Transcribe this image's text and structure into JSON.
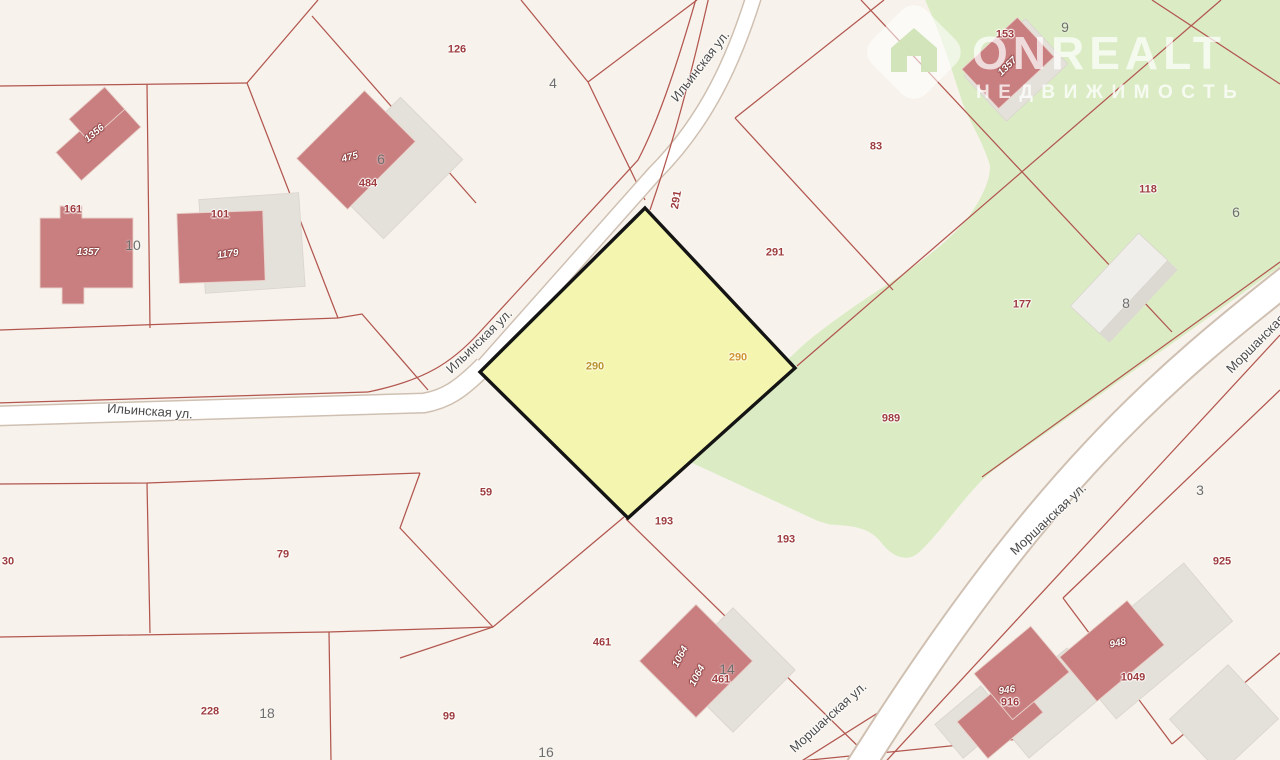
{
  "watermark": {
    "brand": "ONREALT",
    "subtitle": "НЕДВИЖИМОСТЬ"
  },
  "map": {
    "colors": {
      "background": "#f7f3ec",
      "green_zone": "#dbecc5",
      "parcel_line": "#b2564f",
      "street_fill": "#ffffff",
      "street_casing": "#cfc0b2",
      "highlight_fill": "#f4f6b0",
      "highlight_inner": "#eef28c",
      "highlight_border": "#141414",
      "building_fill": "#c97f80",
      "building_shadow": "#e4e1da",
      "addr_label": "#9d3b3d",
      "parcel_number": "#6e6e6e",
      "street_label": "#4a4a4a"
    },
    "highlighted_parcel_number": "290"
  },
  "labels": [
    {
      "t": "Ильинская ул.",
      "x": 700,
      "y": 66,
      "r": -52,
      "k": "street"
    },
    {
      "t": "Ильинская ул.",
      "x": 479,
      "y": 341,
      "r": -44,
      "k": "street"
    },
    {
      "t": "Ильинская ул.",
      "x": 150,
      "y": 411,
      "r": 4,
      "k": "street"
    },
    {
      "t": "Моршанская ул.",
      "x": 1048,
      "y": 519,
      "r": -43,
      "k": "street"
    },
    {
      "t": "Моршанская ул.",
      "x": 828,
      "y": 717,
      "r": -42,
      "k": "street"
    },
    {
      "t": "Моршанская ул.",
      "x": 1263,
      "y": 336,
      "r": -45,
      "k": "street"
    },
    {
      "t": "126",
      "x": 457,
      "y": 50,
      "k": "addr"
    },
    {
      "t": "291",
      "x": 677,
      "y": 200,
      "r": -80,
      "k": "addr"
    },
    {
      "t": "291",
      "x": 775,
      "y": 253,
      "k": "addr"
    },
    {
      "t": "83",
      "x": 876,
      "y": 147,
      "k": "addr"
    },
    {
      "t": "118",
      "x": 1148,
      "y": 190,
      "k": "addr"
    },
    {
      "t": "177",
      "x": 1022,
      "y": 305,
      "k": "addr"
    },
    {
      "t": "989",
      "x": 891,
      "y": 419,
      "k": "addr"
    },
    {
      "t": "153",
      "x": 1005,
      "y": 35,
      "k": "addr"
    },
    {
      "t": "161",
      "x": 73,
      "y": 210,
      "k": "addr"
    },
    {
      "t": "101",
      "x": 220,
      "y": 215,
      "k": "addr"
    },
    {
      "t": "484",
      "x": 368,
      "y": 184,
      "k": "addr"
    },
    {
      "t": "59",
      "x": 486,
      "y": 493,
      "k": "addr"
    },
    {
      "t": "193",
      "x": 664,
      "y": 522,
      "k": "addr"
    },
    {
      "t": "193",
      "x": 786,
      "y": 540,
      "k": "addr"
    },
    {
      "t": "461",
      "x": 602,
      "y": 643,
      "k": "addr"
    },
    {
      "t": "461",
      "x": 721,
      "y": 680,
      "k": "addr"
    },
    {
      "t": "99",
      "x": 449,
      "y": 717,
      "k": "addr"
    },
    {
      "t": "79",
      "x": 283,
      "y": 555,
      "k": "addr"
    },
    {
      "t": "30",
      "x": 8,
      "y": 562,
      "k": "addr"
    },
    {
      "t": "228",
      "x": 210,
      "y": 712,
      "k": "addr"
    },
    {
      "t": "925",
      "x": 1222,
      "y": 562,
      "k": "addr"
    },
    {
      "t": "916",
      "x": 1010,
      "y": 703,
      "k": "addr"
    },
    {
      "t": "1049",
      "x": 1133,
      "y": 678,
      "k": "addr"
    },
    {
      "t": "290",
      "x": 595,
      "y": 367,
      "k": "gold",
      "c": "#b9932f"
    },
    {
      "t": "290",
      "x": 738,
      "y": 358,
      "k": "gold",
      "c": "#d09434"
    },
    {
      "t": "4",
      "x": 553,
      "y": 83,
      "k": "num"
    },
    {
      "t": "6",
      "x": 381,
      "y": 159,
      "k": "num"
    },
    {
      "t": "9",
      "x": 1065,
      "y": 27,
      "k": "num"
    },
    {
      "t": "6",
      "x": 1236,
      "y": 212,
      "k": "num"
    },
    {
      "t": "8",
      "x": 1126,
      "y": 303,
      "k": "num"
    },
    {
      "t": "10",
      "x": 133,
      "y": 245,
      "k": "num"
    },
    {
      "t": "3",
      "x": 1200,
      "y": 490,
      "k": "num"
    },
    {
      "t": "18",
      "x": 267,
      "y": 713,
      "k": "num"
    },
    {
      "t": "14",
      "x": 727,
      "y": 669,
      "k": "num"
    },
    {
      "t": "16",
      "x": 546,
      "y": 752,
      "k": "num"
    },
    {
      "t": "1356",
      "x": 95,
      "y": 134,
      "r": -40,
      "k": "bld"
    },
    {
      "t": "1357",
      "x": 88,
      "y": 253,
      "r": 0,
      "k": "bld"
    },
    {
      "t": "1179",
      "x": 228,
      "y": 255,
      "r": -8,
      "k": "bld"
    },
    {
      "t": "475",
      "x": 350,
      "y": 158,
      "r": -15,
      "k": "bld"
    },
    {
      "t": "1357",
      "x": 1008,
      "y": 67,
      "r": -45,
      "k": "bld"
    },
    {
      "t": "1064",
      "x": 681,
      "y": 657,
      "r": -62,
      "k": "bld"
    },
    {
      "t": "1064",
      "x": 698,
      "y": 676,
      "r": -62,
      "k": "bld"
    },
    {
      "t": "946",
      "x": 1007,
      "y": 691,
      "r": -8,
      "k": "bld"
    },
    {
      "t": "948",
      "x": 1118,
      "y": 644,
      "r": -12,
      "k": "bld"
    }
  ]
}
